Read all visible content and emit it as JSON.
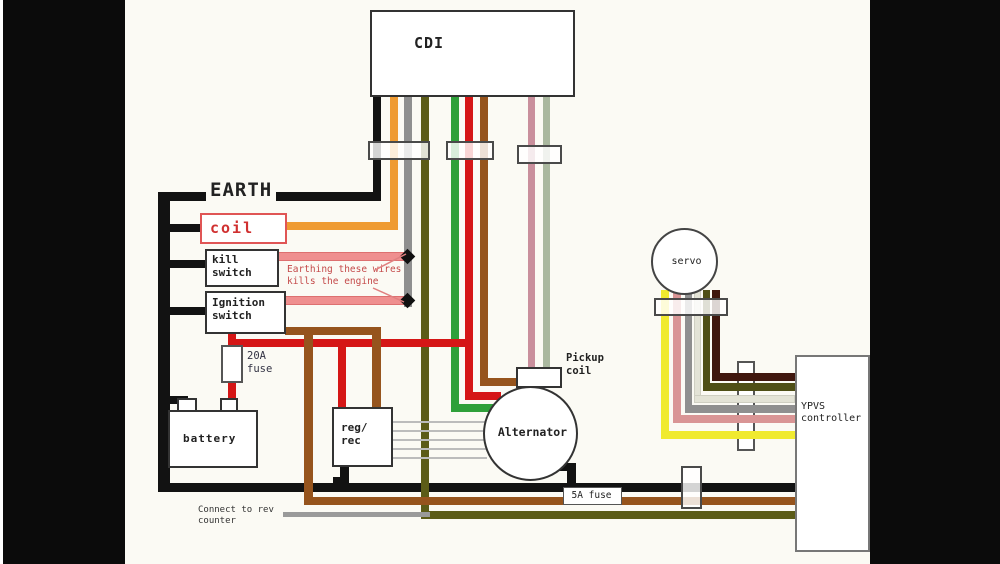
{
  "diagram": {
    "description": "Motorcycle CDI / YPVS wiring diagram",
    "components": {
      "cdi": {
        "label": "CDI"
      },
      "earth": {
        "label": "EARTH"
      },
      "coil": {
        "label": "coil"
      },
      "kill_switch": {
        "label": "kill switch"
      },
      "ignition_switch": {
        "label": "Ignition switch"
      },
      "fuse_20a": {
        "label": "20A fuse"
      },
      "battery": {
        "label": "battery"
      },
      "reg_rec": {
        "label": "reg/ rec"
      },
      "alternator": {
        "label": "Alternator"
      },
      "pickup_coil": {
        "label": "Pickup coil"
      },
      "servo": {
        "label": "servo"
      },
      "ypvs_controller": {
        "label": "YPVS controller"
      },
      "fuse_5a": {
        "label": "5A fuse"
      },
      "note_rev_counter": {
        "label": "Connect to rev counter"
      },
      "note_warning": {
        "label": "Earthing these wires kills the engine"
      }
    },
    "wire_colors": {
      "earth_black": "#121212",
      "orange": "#ef9b32",
      "gray": "#8f8f8f",
      "olive": "#5c5c18",
      "green": "#2fa03a",
      "red": "#d51616",
      "brown": "#96541d",
      "pickup_pink": "#c98f9c",
      "pickup_sage": "#aab89f",
      "kill_salmon": "#ef8f8f",
      "servo_yellow": "#f0ea2f",
      "servo_pink": "#d99595",
      "servo_white": "#e3e3d6",
      "servo_olive": "#4f4f16",
      "servo_maroon": "#40170e",
      "rev_counter_gray": "#9a9a9a",
      "warning_text": "#c44a4a"
    }
  }
}
